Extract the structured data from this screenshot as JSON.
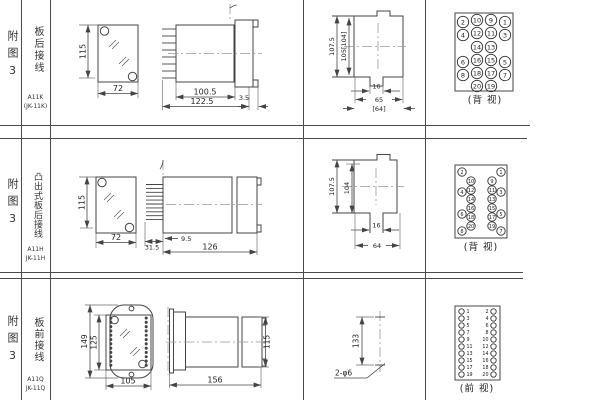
{
  "rows": [
    {
      "fig_label": "附图3",
      "wiring_label": "板后接线",
      "model_line1": "A11K",
      "model_line2": "(JK-11K)",
      "front": {
        "height": "115",
        "width": "72"
      },
      "side": {
        "body": "100.5",
        "total": "122.5",
        "panel": "3.5"
      },
      "cutout": {
        "outer_h": "107.5",
        "inner_h": "105[104]",
        "slot_w": "16",
        "w": "65",
        "w2": "[64]"
      },
      "view_label": "(背 视)",
      "terminals": [
        {
          "n": "2",
          "x": 463,
          "y": 22
        },
        {
          "n": "10",
          "x": 477,
          "y": 20
        },
        {
          "n": "9",
          "x": 491,
          "y": 20
        },
        {
          "n": "1",
          "x": 505,
          "y": 22
        },
        {
          "n": "4",
          "x": 463,
          "y": 35
        },
        {
          "n": "12",
          "x": 477,
          "y": 33
        },
        {
          "n": "11",
          "x": 491,
          "y": 33
        },
        {
          "n": "3",
          "x": 505,
          "y": 35
        },
        {
          "n": "14",
          "x": 477,
          "y": 47
        },
        {
          "n": "13",
          "x": 491,
          "y": 47
        },
        {
          "n": "6",
          "x": 463,
          "y": 62
        },
        {
          "n": "16",
          "x": 477,
          "y": 60
        },
        {
          "n": "15",
          "x": 491,
          "y": 60
        },
        {
          "n": "5",
          "x": 505,
          "y": 62
        },
        {
          "n": "8",
          "x": 463,
          "y": 75
        },
        {
          "n": "18",
          "x": 477,
          "y": 73
        },
        {
          "n": "17",
          "x": 491,
          "y": 73
        },
        {
          "n": "7",
          "x": 505,
          "y": 75
        },
        {
          "n": "20",
          "x": 477,
          "y": 86
        },
        {
          "n": "19",
          "x": 491,
          "y": 86
        }
      ]
    },
    {
      "fig_label": "附图3",
      "wiring_label": "凸出式板后接线",
      "model_line1": "A11H",
      "model_line2": "JK-11H",
      "front": {
        "height": "115",
        "width": "72"
      },
      "side": {
        "pins": "31.5",
        "offset": "9.5",
        "total": "126"
      },
      "cutout": {
        "outer_h": "107.5",
        "inner_h": "104",
        "slot_w": "16",
        "w": "64"
      },
      "view_label": "(背 视)",
      "terminals": [
        {
          "n": "2",
          "x": 462,
          "y": 34
        },
        {
          "n": "10",
          "x": 471,
          "y": 43
        },
        {
          "n": "12",
          "x": 471,
          "y": 52
        },
        {
          "n": "4",
          "x": 462,
          "y": 54
        },
        {
          "n": "14",
          "x": 471,
          "y": 61
        },
        {
          "n": "16",
          "x": 471,
          "y": 70
        },
        {
          "n": "6",
          "x": 462,
          "y": 76
        },
        {
          "n": "18",
          "x": 471,
          "y": 79
        },
        {
          "n": "20",
          "x": 471,
          "y": 88
        },
        {
          "n": "8",
          "x": 462,
          "y": 93
        },
        {
          "n": "1",
          "x": 501,
          "y": 34
        },
        {
          "n": "9",
          "x": 492,
          "y": 43
        },
        {
          "n": "11",
          "x": 492,
          "y": 52
        },
        {
          "n": "3",
          "x": 501,
          "y": 54
        },
        {
          "n": "13",
          "x": 492,
          "y": 61
        },
        {
          "n": "15",
          "x": 492,
          "y": 70
        },
        {
          "n": "5",
          "x": 501,
          "y": 76
        },
        {
          "n": "17",
          "x": 492,
          "y": 79
        },
        {
          "n": "19",
          "x": 492,
          "y": 88
        },
        {
          "n": "7",
          "x": 501,
          "y": 93
        }
      ]
    },
    {
      "fig_label": "附图3",
      "wiring_label": "板前接线",
      "model_line1": "A11Q",
      "model_line2": "JK-11Q",
      "front": {
        "height": "149",
        "inner_height": "125",
        "width": "105"
      },
      "side": {
        "total": "156",
        "height": "115"
      },
      "holes": {
        "spacing": "133",
        "note": "2-φ6"
      },
      "view_label": "(前 视)",
      "terminals": [
        {
          "n": "1",
          "x": 461.5,
          "y": 33.5,
          "tx": 466.5,
          "anchor": "start"
        },
        {
          "n": "2",
          "x": 493.5,
          "y": 33.5,
          "tx": 488.5,
          "anchor": "end"
        },
        {
          "n": "3",
          "x": 461.5,
          "y": 40.5,
          "tx": 466.5,
          "anchor": "start"
        },
        {
          "n": "4",
          "x": 493.5,
          "y": 40.5,
          "tx": 488.5,
          "anchor": "end"
        },
        {
          "n": "5",
          "x": 461.5,
          "y": 47.5,
          "tx": 466.5,
          "anchor": "start"
        },
        {
          "n": "6",
          "x": 493.5,
          "y": 47.5,
          "tx": 488.5,
          "anchor": "end"
        },
        {
          "n": "7",
          "x": 461.5,
          "y": 54.5,
          "tx": 466.5,
          "anchor": "start"
        },
        {
          "n": "8",
          "x": 493.5,
          "y": 54.5,
          "tx": 488.5,
          "anchor": "end"
        },
        {
          "n": "9",
          "x": 461.5,
          "y": 61.5,
          "tx": 466.5,
          "anchor": "start"
        },
        {
          "n": "10",
          "x": 493.5,
          "y": 61.5,
          "tx": 488.5,
          "anchor": "end"
        },
        {
          "n": "11",
          "x": 461.5,
          "y": 68.5,
          "tx": 466.5,
          "anchor": "start"
        },
        {
          "n": "12",
          "x": 493.5,
          "y": 68.5,
          "tx": 488.5,
          "anchor": "end"
        },
        {
          "n": "13",
          "x": 461.5,
          "y": 75.5,
          "tx": 466.5,
          "anchor": "start"
        },
        {
          "n": "14",
          "x": 493.5,
          "y": 75.5,
          "tx": 488.5,
          "anchor": "end"
        },
        {
          "n": "15",
          "x": 461.5,
          "y": 82.5,
          "tx": 466.5,
          "anchor": "start"
        },
        {
          "n": "16",
          "x": 493.5,
          "y": 82.5,
          "tx": 488.5,
          "anchor": "end"
        },
        {
          "n": "17",
          "x": 461.5,
          "y": 89.5,
          "tx": 466.5,
          "anchor": "start"
        },
        {
          "n": "18",
          "x": 493.5,
          "y": 89.5,
          "tx": 488.5,
          "anchor": "end"
        },
        {
          "n": "19",
          "x": 461.5,
          "y": 96.5,
          "tx": 466.5,
          "anchor": "start"
        },
        {
          "n": "20",
          "x": 493.5,
          "y": 96.5,
          "tx": 488.5,
          "anchor": "end"
        }
      ]
    }
  ]
}
